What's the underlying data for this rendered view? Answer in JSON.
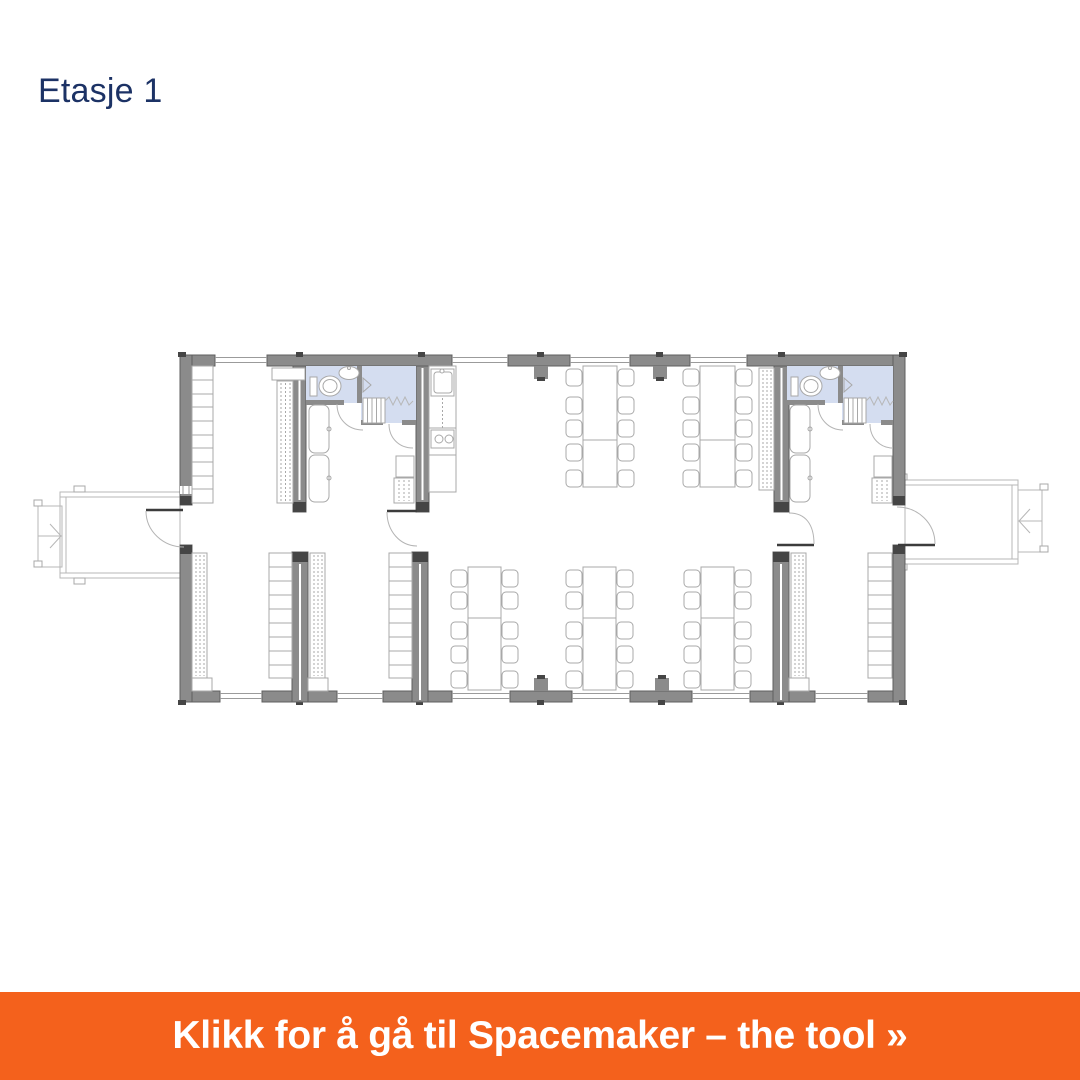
{
  "page": {
    "title": "Etasje 1"
  },
  "banner": {
    "label": "Klikk for å gå til Spacemaker – the tool »"
  },
  "floor_plan": {
    "floor_label": "Etasje 1",
    "elements": [
      "entrance-ramp-left",
      "entrance-porch-left",
      "wardrobe-room-left",
      "wc-room-left",
      "staircase-left",
      "lounge-seating-left",
      "kitchen",
      "dining-tables-upper",
      "wc-room-right",
      "staircase-right",
      "lounge-seating-right",
      "entrance-porch-right",
      "entrance-ramp-right",
      "group-rooms-lower",
      "dining-tables-lower"
    ]
  },
  "colors": {
    "page-bg": "#ffffff",
    "title-text": "#1c3265",
    "banner-bg": "#f4611c",
    "banner-text": "#ffffff",
    "wall": "#8b8b8b",
    "wall-edge": "#5f5f5f",
    "wall-cap": "#454545",
    "room-blue": "#d4ddf0",
    "furniture-line": "#a8a8a8",
    "window-line": "#9b9b9b",
    "door-leaf": "#3c3c3c",
    "door-arc": "#b4b4b4"
  }
}
